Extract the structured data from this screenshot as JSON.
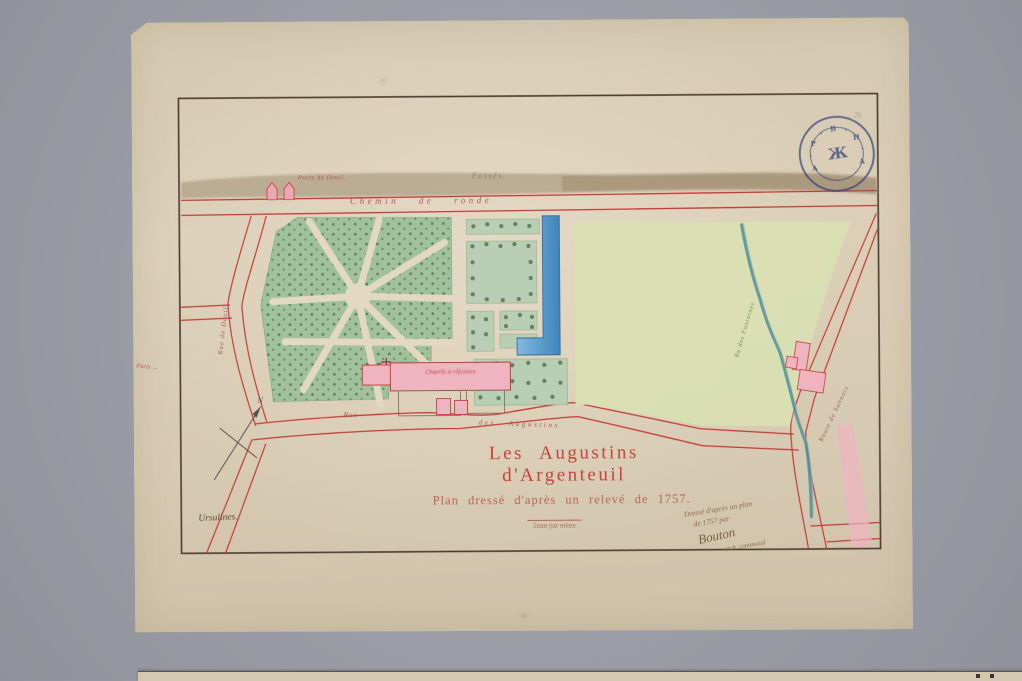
{
  "document": {
    "type": "archival plan photograph",
    "title": "Les Augustins d'Argenteuil",
    "subtitle": "Plan dressé d'après un relevé de 1757.",
    "scale_note": "1mm par mètre",
    "pencil_note": "26"
  },
  "map": {
    "labels": {
      "porte": "Porte de Deuil.",
      "fosses": "Fossés.",
      "chemin_de_ronde": "Chemin de ronde",
      "rue_de_deuil": "Rue de Deuil",
      "rue": "Rue",
      "des_augustins": "des Augustins",
      "chapelle": "Chapelle et réfectoire",
      "route_sannois": "Route de Sannois",
      "ru_stream": "Ru des Fontaines",
      "ursulines": "Ursulines.",
      "paris": "Paris →",
      "north": "N"
    },
    "handwritten_note": {
      "line1": "Dressé d'après un plan",
      "line2": "de 1757 par",
      "signature": "Bouton",
      "line4": "arch. communal"
    }
  },
  "stamp": {
    "ring_letters": "·A·P·B·H·A·",
    "monogram": "Ж"
  },
  "colors": {
    "backdrop": "#9b9da6",
    "paper": "#d8ccb5",
    "frame": "#4c3b2a",
    "road_red": "#c23b3c",
    "bosquet_green": "#a1c09c",
    "parterre_green": "#b9cfb5",
    "field_green": "#d9dfb3",
    "canal_blue": "#4f93c4",
    "building_pink": "#f0b4c0",
    "ditch_tan": "#b5a68c",
    "stamp_blue": "#31427c",
    "ink_red": "#c5403c",
    "ink_brown": "#8a6b4e"
  }
}
